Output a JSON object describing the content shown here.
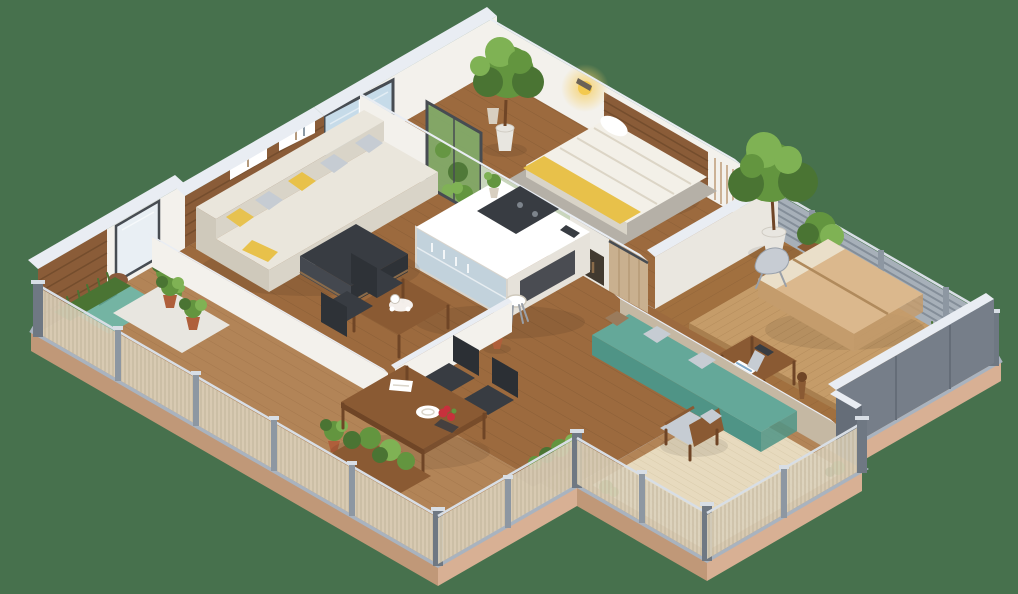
{
  "view": {
    "label": "3D isometric apartment floor plan render",
    "background": "flat green",
    "projection": "isometric"
  },
  "colors": {
    "bg": "#47714D",
    "slab": "#D8B094",
    "slabEdge": "#C09878",
    "margin": "#BCC3CD",
    "rim": "#A9B3BF",
    "woodInterior": "#9C6A3E",
    "woodSeam": "#7C5330",
    "deck": "#B28457",
    "deckSeam": "#94683F",
    "parquet": "#A1703F",
    "platform": "#C59C69",
    "platformSeam": "#A87F4F",
    "rug": "#E7DABE",
    "rugLine": "#D1C2A0",
    "wallWhite": "#F3F1EC",
    "wallShade": "#E6E2DA",
    "wallDim": "#EAE7E0",
    "cap": "#E9EDF3",
    "slatWood": "#8A5C38",
    "slatLine": "#5E3D22",
    "greenWall": "#C9D6BD",
    "glassBlue": "#C6DBE9",
    "glassFrost": "#E9EFF4",
    "glassGreen": "#7FAE6C",
    "frameDark": "#474C52",
    "fenceGray": "#A7B0B9",
    "fenceLine": "#7E8893",
    "postGray": "#8D97A2",
    "postDark": "#6F7883",
    "postLight": "#D8DEE5",
    "mesh": "#DCD2BC",
    "meshLine": "#BFB297",
    "grayWall": "#767E89",
    "grayWallDark": "#656D78",
    "tanWall": "#C5B8A3",
    "benchTeal": "#64A899",
    "benchTealDark": "#4F9486",
    "tealCushion": "#74B4A3",
    "cream": "#EAE6DC",
    "creamDim": "#D9D4C8",
    "creamDark": "#CFC9BB",
    "cushionGray": "#C6CCD3",
    "yellow": "#E8C14A",
    "furnWood": "#8A5A33",
    "furnWoodDark": "#6F4526",
    "darkFurn": "#383C42",
    "bedWhite": "#F3F0E8",
    "bedStripe": "#DCD5C6",
    "stone": "#B5B0A7",
    "masterBed": "#DBB88D",
    "masterBedDim": "#C49C6C",
    "masterSeam": "#B08A5C",
    "folDark": "#4A7433",
    "folMid": "#63953F",
    "folLight": "#7FB254",
    "terracotta": "#AF5F3B",
    "potWhite": "#E8E6E0",
    "potBeige": "#D8CFC0",
    "white": "#FFFFFF",
    "red": "#C8303C",
    "glow": "#F6D06A",
    "nicheDark": "#423A30",
    "blue": "#7FA8C9",
    "silver": "#C7CCD3"
  },
  "scene": {
    "rooms": [
      {
        "name": "living-room",
        "items": [
          "sectional-sofa",
          "gray-pillows",
          "yellow-pillows",
          "dark-ottoman",
          "slat-accent-wall",
          "wall-shelves",
          "picture-window",
          "potted-plants"
        ]
      },
      {
        "name": "kitchen",
        "items": [
          "island-counter",
          "cooktop",
          "glass-display-base",
          "bar-stool",
          "vase-plant",
          "tall-cabinet-wall",
          "green-glass-door"
        ]
      },
      {
        "name": "study-nook",
        "items": [
          "tea-table",
          "tea-set",
          "two-dark-chairs",
          "white-half-walls",
          "potted-plant"
        ]
      },
      {
        "name": "small-bedroom",
        "items": [
          "single-bed",
          "striped-duvet",
          "yellow-throw",
          "stone-bed-base",
          "wood-headboard-panel",
          "wall-lamp-glow",
          "potted-tree",
          "ceramic-pots",
          "sage-green-wall",
          "book-niche",
          "sliding-wood-door"
        ]
      },
      {
        "name": "master-bedroom-terrace",
        "items": [
          "double-mattress-bed",
          "slatted-platform-deck",
          "louvered-privacy-fence",
          "potted-tree",
          "shrub-planter",
          "silver-lounge-chair",
          "desk",
          "desk-chair-with-blue-throw",
          "wooden-floor-lamp",
          "teal-bench",
          "gray-panel-walls"
        ]
      },
      {
        "name": "patio",
        "items": [
          "woven-area-rug",
          "wood-armchair-gray-cushions",
          "grass-tufts",
          "mesh-railing"
        ]
      },
      {
        "name": "wraparound-balcony",
        "items": [
          "dining-table",
          "two-black-chairs",
          "white-plate",
          "napkins",
          "red-rose-centerpiece",
          "planter-boxes",
          "teal-lounge-cushion",
          "plant-tray-terracotta-pots",
          "grass-planter",
          "mesh-railing-gray-posts"
        ]
      }
    ]
  }
}
